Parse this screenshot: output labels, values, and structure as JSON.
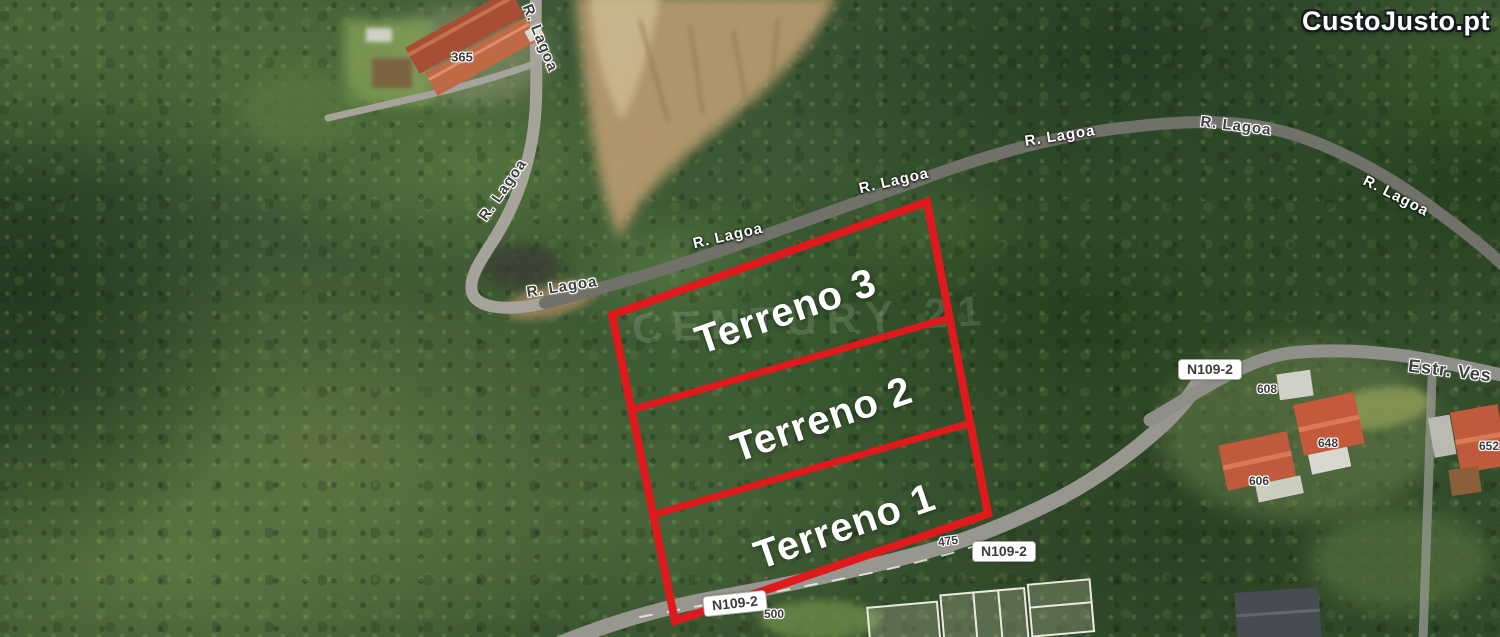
{
  "source_watermark": {
    "brand": "CustoJusto.pt"
  },
  "agency_watermark": {
    "text": "CENTURY 21"
  },
  "parcels": [
    {
      "label": "Terreno 3"
    },
    {
      "label": "Terreno 2"
    },
    {
      "label": "Terreno 1"
    }
  ],
  "road_labels": {
    "r_lagoa": "R. Lagoa",
    "n109_2": "N109-2",
    "estr": "Estr. Ves"
  },
  "house_numbers": [
    "365",
    "475",
    "500",
    "608",
    "648",
    "652",
    "606"
  ],
  "colors": {
    "parcel_outline": "#e0191d",
    "road_label_dark": "#3f3f3f",
    "road_label_light": "#ffffff",
    "brand_text": "#ffffff"
  }
}
